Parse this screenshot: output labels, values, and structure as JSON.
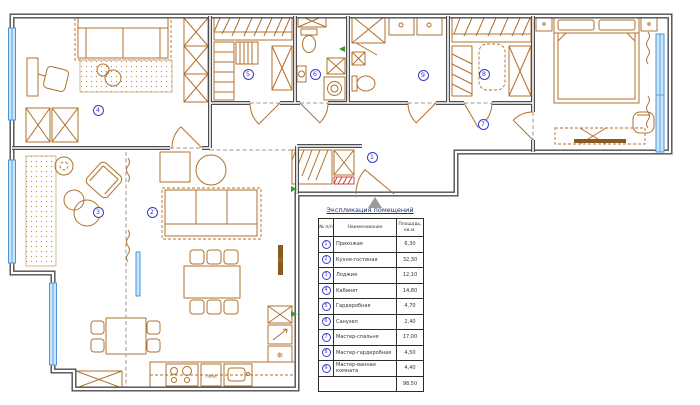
{
  "plan": {
    "rooms": [
      {
        "num": "1",
        "name": "Прихожая",
        "area": "6,30",
        "marker": {
          "x": 372,
          "y": 157
        }
      },
      {
        "num": "2",
        "name": "Кухня-гостиная",
        "area": "32,30",
        "marker": {
          "x": 152,
          "y": 212
        }
      },
      {
        "num": "3",
        "name": "Лоджия",
        "area": "12,10",
        "marker": {
          "x": 98,
          "y": 212
        }
      },
      {
        "num": "4",
        "name": "Кабинет",
        "area": "14,80",
        "marker": {
          "x": 98,
          "y": 110
        }
      },
      {
        "num": "5",
        "name": "Гардеробная",
        "area": "4,70",
        "marker": {
          "x": 248,
          "y": 74
        }
      },
      {
        "num": "6",
        "name": "Санузел",
        "area": "2,40",
        "marker": {
          "x": 315,
          "y": 74
        }
      },
      {
        "num": "7",
        "name": "Мастер-спальня",
        "area": "17,00",
        "marker": {
          "x": 483,
          "y": 124
        }
      },
      {
        "num": "8",
        "name": "Мастер-гардеробная",
        "area": "4,50",
        "marker": {
          "x": 484,
          "y": 74
        }
      },
      {
        "num": "9",
        "name": "Мастер-ванная комната",
        "area": "4,40",
        "marker": {
          "x": 423,
          "y": 75
        }
      }
    ],
    "total_area": "98,50",
    "labels": {
      "dishwasher": "ПММ",
      "freezer_icon": "❄"
    }
  },
  "table": {
    "title": "Экспликация помещений",
    "col_num": "№ п/п",
    "col_name": "Наименование",
    "col_area": "Площадь, кв.м."
  },
  "colors": {
    "wall": "#4d4d4d",
    "furniture": "#b0702c",
    "window": "#4a94d8",
    "marker": "#3a3ad0",
    "accent_red": "#cc3333",
    "accent_green": "#2f9e2f"
  }
}
